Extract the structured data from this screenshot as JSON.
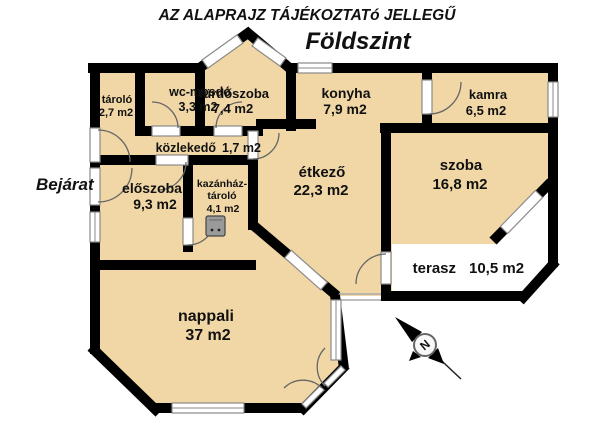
{
  "titles": {
    "disclaimer": "AZ ALAPRAJZ TÁJÉKOZTATó JELLEGŰ",
    "floor": "Földszint"
  },
  "entrance_label": "Bejárat",
  "compass": {
    "letter": "N"
  },
  "rooms": [
    {
      "id": "tarolo",
      "name": "tároló",
      "area": "2,7 m2"
    },
    {
      "id": "wc-mosdo",
      "name": "wc-mosdó",
      "area": "3,3 m2"
    },
    {
      "id": "furdoszoba",
      "name": "fürdőszoba",
      "area": "7,4 m2"
    },
    {
      "id": "konyha",
      "name": "konyha",
      "area": "7,9 m2"
    },
    {
      "id": "kamra",
      "name": "kamra",
      "area": "6,5 m2"
    },
    {
      "id": "kozlekedo",
      "name": "közlekedő",
      "area": "1,7 m2"
    },
    {
      "id": "etkezo",
      "name": "étkező",
      "area": "22,3 m2"
    },
    {
      "id": "szoba",
      "name": "szoba",
      "area": "16,8 m2"
    },
    {
      "id": "eloszoba",
      "name": "előszoba",
      "area": "9,3  m2"
    },
    {
      "id": "kazanhaz",
      "name": "kazánház-",
      "name2": "tároló",
      "area": "4,1 m2"
    },
    {
      "id": "terasz",
      "name": "terasz",
      "area": "10,5 m2"
    },
    {
      "id": "nappali",
      "name": "nappali",
      "area": "37 m2"
    }
  ],
  "colors": {
    "floor": "#f1d7a6",
    "wall": "#000000",
    "terrace": "#ffffff",
    "window_frame": "#8a8a8a"
  }
}
